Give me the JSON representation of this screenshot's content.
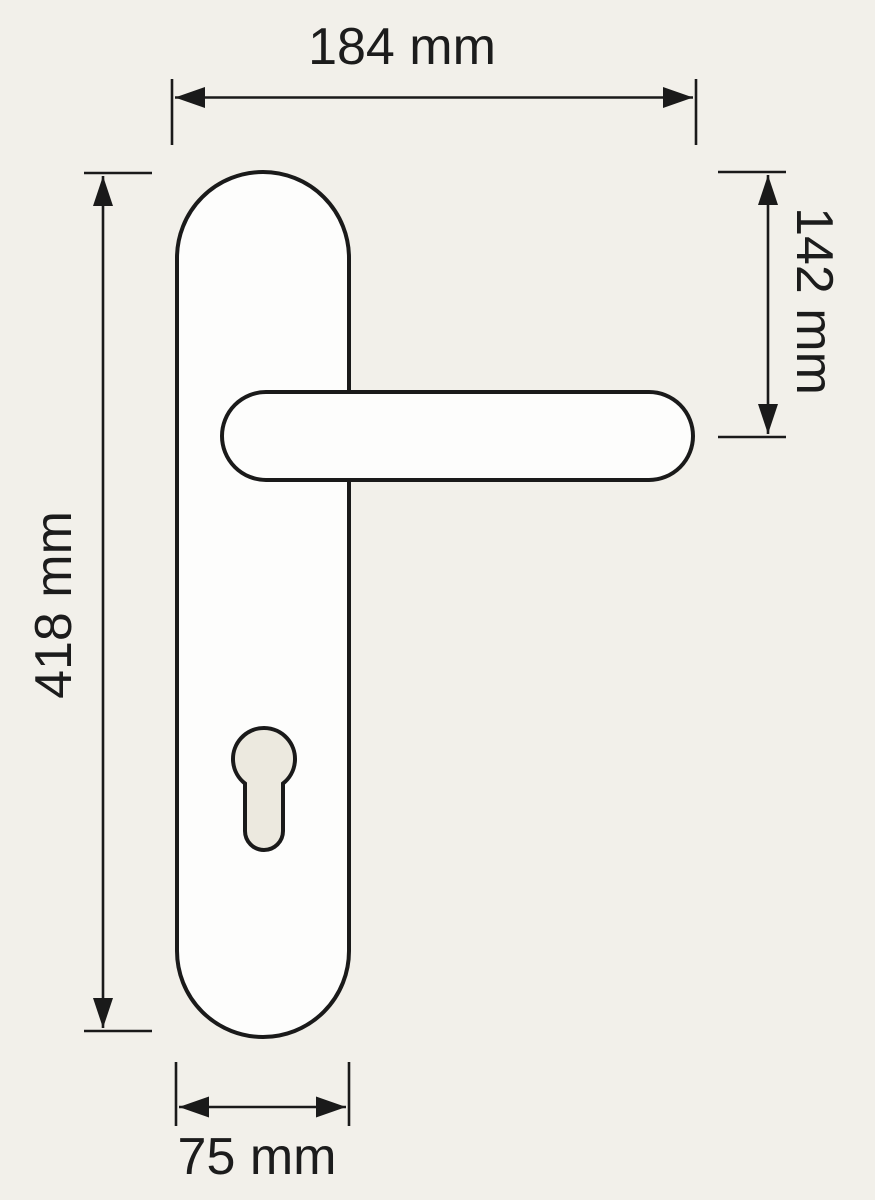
{
  "diagram": {
    "kind": "door-handle-dimension-drawing",
    "labels": {
      "top_width": "184 mm",
      "right_height": "142 mm",
      "left_height": "418 mm",
      "bottom_width": "75 mm"
    },
    "values_mm": {
      "top_width": 184,
      "right_height": 142,
      "left_height": 418,
      "bottom_width": 75
    },
    "colors": {
      "background": "#f2f0ea",
      "line": "#1a1a1a",
      "plate_fill": "#fdfdfc",
      "keyhole_fill": "#ece9df",
      "text": "#1c1c1c"
    }
  }
}
